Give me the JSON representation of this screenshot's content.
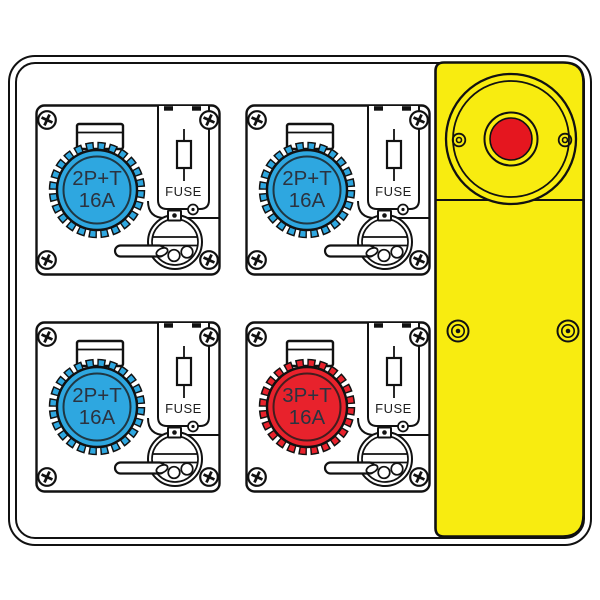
{
  "drawing": {
    "background": "#ffffff",
    "line_color": "#111111"
  },
  "modules": [
    {
      "id": "socket-module-top-left",
      "position": "top-left",
      "label_line1": "2P+T",
      "label_line2": "16A",
      "fuse_label": "FUSE",
      "socket_color": "#2EA7E0"
    },
    {
      "id": "socket-module-top-right",
      "position": "top-right",
      "label_line1": "2P+T",
      "label_line2": "16A",
      "fuse_label": "FUSE",
      "socket_color": "#2EA7E0"
    },
    {
      "id": "socket-module-bottom-left",
      "position": "bottom-left",
      "label_line1": "2P+T",
      "label_line2": "16A",
      "fuse_label": "FUSE",
      "socket_color": "#2EA7E0"
    },
    {
      "id": "socket-module-bottom-right",
      "position": "bottom-right",
      "label_line1": "3P+T",
      "label_line2": "16A",
      "fuse_label": "FUSE",
      "socket_color": "#E8222C"
    }
  ],
  "emergency_panel": {
    "panel_color": "#F8EC10",
    "stop_button_color": "#E5161F"
  }
}
